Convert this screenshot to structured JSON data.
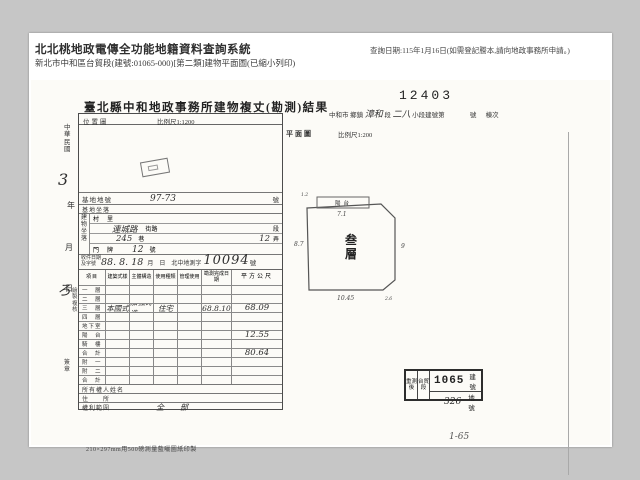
{
  "header": {
    "system_title": "北北桃地政電傳全功能地籍資料查詢系統",
    "subtitle": "新北市中和區台貿段(建號:01065-000)[第二類]建物平面圖(已縮小列印)",
    "query_note": "查詢日期:115年1月16日(如需登記謄本,請向地政事務所申請。)"
  },
  "scan": {
    "doc_number": "12403",
    "title": "臺北縣中和地政事務所建物複丈(勘測)結果",
    "township": {
      "city": "中和市",
      "unit1": "鄉鎮",
      "hw_section": "漳和",
      "seg": "段",
      "hw_small": "二八",
      "unit2": "小段建號第",
      "unit3": "號",
      "unit4": "棟次"
    },
    "margin": {
      "era": "中華民國",
      "hw_a": "3",
      "year": "年",
      "month": "月",
      "hw_b": "ろ",
      "day": "日",
      "staff": "繪製複核",
      "sign": "簽章"
    },
    "location_map": {
      "label": "位置圖",
      "scale": "比例尺1:1200"
    },
    "site_row": {
      "label": "基地地號",
      "value": "97-73",
      "unit": "號"
    },
    "site_row2": {
      "label": "基地坐落"
    },
    "address": {
      "group": "建物坐落",
      "village": "村　里",
      "street_hw": "連城路",
      "street_label": "街路",
      "street_unit": "段",
      "lane_hw": "245",
      "lane_label": "巷",
      "alley_hw": "12",
      "alley_label": "弄",
      "door_label": "門　牌",
      "door_hw": "12",
      "door_unit": "號"
    },
    "receipt": {
      "label1": "收件日期",
      "label2": "及字號",
      "hw_date": "88. 8. 18",
      "printed": "月　日　北中地測字",
      "hw_no": "10094",
      "unit": "號"
    },
    "table": {
      "col_item": "項目",
      "columns": [
        "建築式樣",
        "主體構造",
        "使用種類",
        "管理使用",
        "勘測完成日期",
        "平方公尺"
      ],
      "rows": [
        {
          "label": "一　層",
          "cells": [
            "",
            "",
            "",
            "",
            "",
            ""
          ]
        },
        {
          "label": "二　層",
          "cells": [
            "",
            "",
            "",
            "",
            "",
            ""
          ]
        },
        {
          "label": "三　層",
          "cells": [
            "本國式",
            "加強磚造",
            "住宅",
            "",
            "68.8.10",
            "68.09"
          ]
        },
        {
          "label": "四　層",
          "cells": [
            "",
            "",
            "",
            "",
            "",
            ""
          ]
        },
        {
          "label": "地下室",
          "cells": [
            "",
            "",
            "",
            "",
            "",
            ""
          ]
        },
        {
          "label": "陽　台",
          "cells": [
            "",
            "",
            "",
            "",
            "",
            "12.55"
          ]
        },
        {
          "label": "騎　樓",
          "cells": [
            "",
            "",
            "",
            "",
            "",
            ""
          ]
        },
        {
          "label": "合　計",
          "cells": [
            "",
            "",
            "",
            "",
            "",
            "80.64"
          ]
        },
        {
          "label": "附　一",
          "cells": [
            "",
            "",
            "",
            "",
            "",
            ""
          ]
        },
        {
          "label": "附　二",
          "cells": [
            "",
            "",
            "",
            "",
            "",
            ""
          ]
        },
        {
          "label": "合　計",
          "cells": [
            "",
            "",
            "",
            "",
            "",
            ""
          ]
        }
      ],
      "owner_rows": [
        {
          "label": "所有權人姓名",
          "value": ""
        },
        {
          "label": "住　　所",
          "value": ""
        },
        {
          "label": "權利範圍",
          "value": "全　部"
        }
      ]
    },
    "footnote": "210×297mm用500磅測量藍曬圖紙印製",
    "plan": {
      "label": "平面圖",
      "scale": "比例尺1:200",
      "floor_label": "叁層",
      "balcony_label": "陽台",
      "dims": {
        "left": "8.7",
        "right": "9",
        "bottom": "10.45",
        "balcony": "7.1",
        "tl": "1.2",
        "br": "2.6"
      }
    },
    "stamp": {
      "re_survey": "重測後",
      "section": "台貿段",
      "building_no": "1065",
      "building_unit": "建號",
      "land_no": "326",
      "land_unit": "地號"
    },
    "hw_note": "1-65"
  }
}
